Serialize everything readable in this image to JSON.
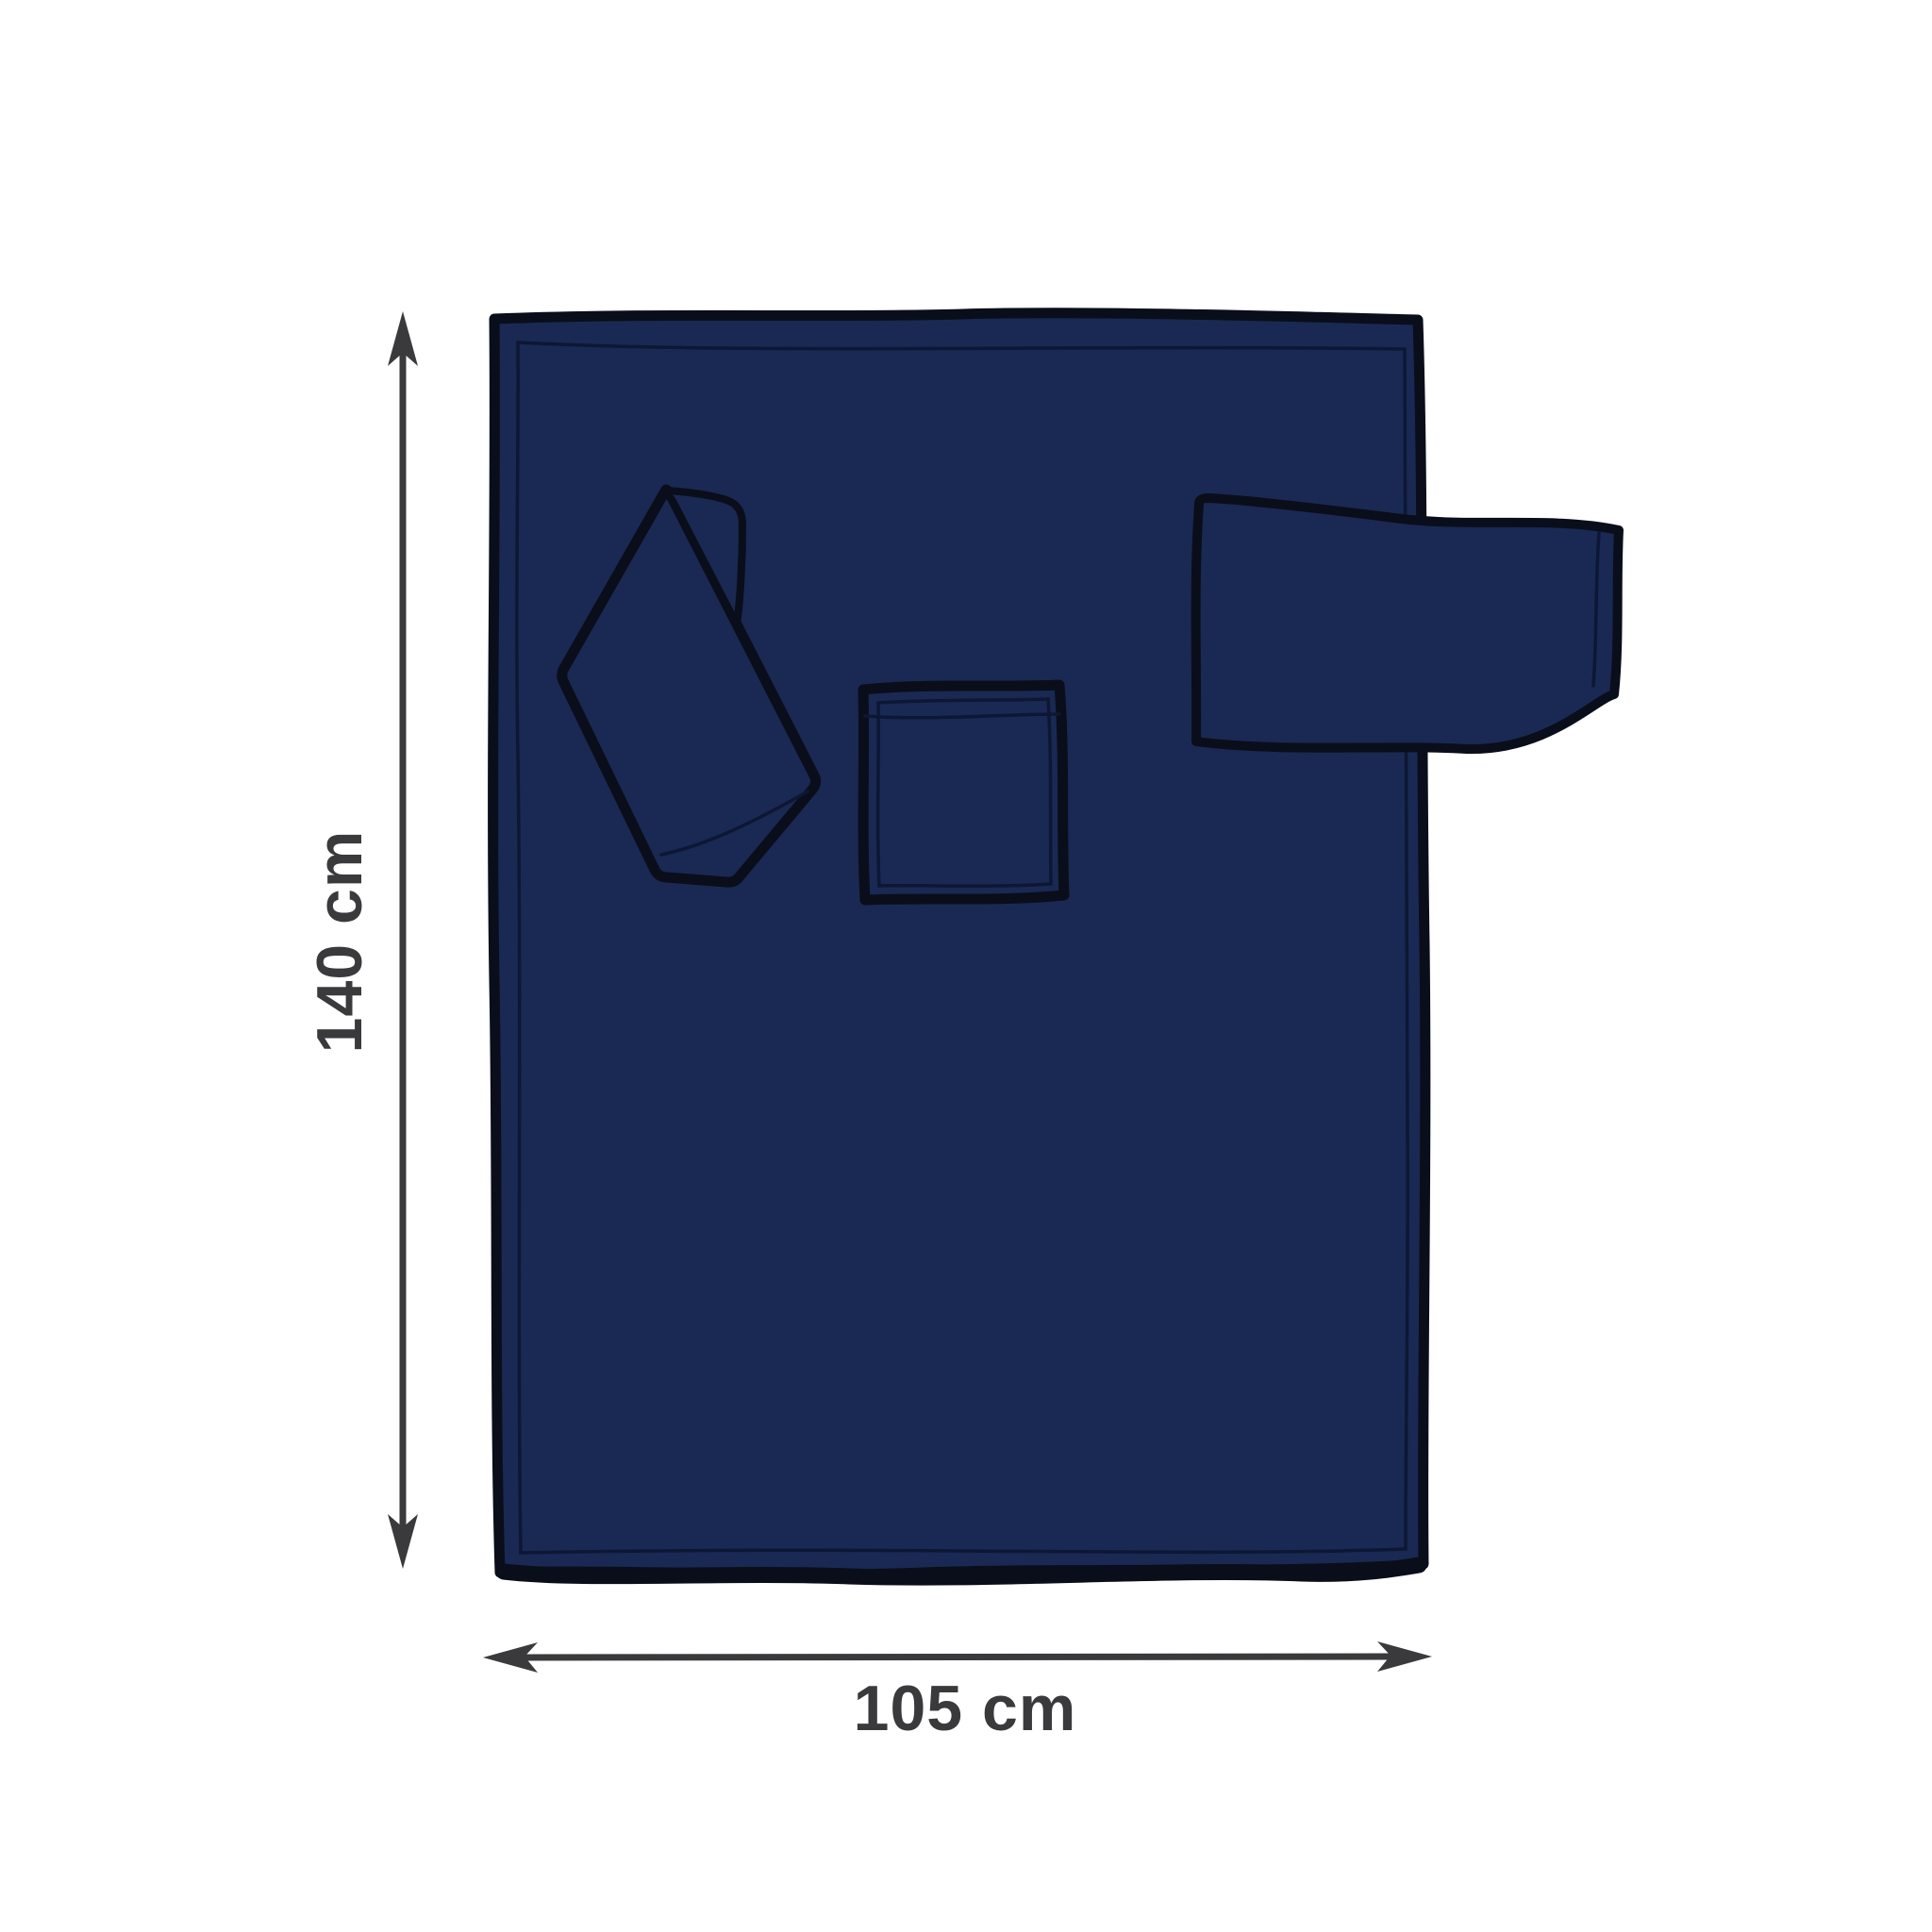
{
  "dimensions": {
    "height": {
      "label": "140 cm"
    },
    "width": {
      "label": "105 cm"
    }
  },
  "colors": {
    "background": "#ffffff",
    "blanket-fill": "#1a2953",
    "outline": "#0a0e1a",
    "stitch": "#0d1734",
    "dimension": "#3a3a3c"
  }
}
